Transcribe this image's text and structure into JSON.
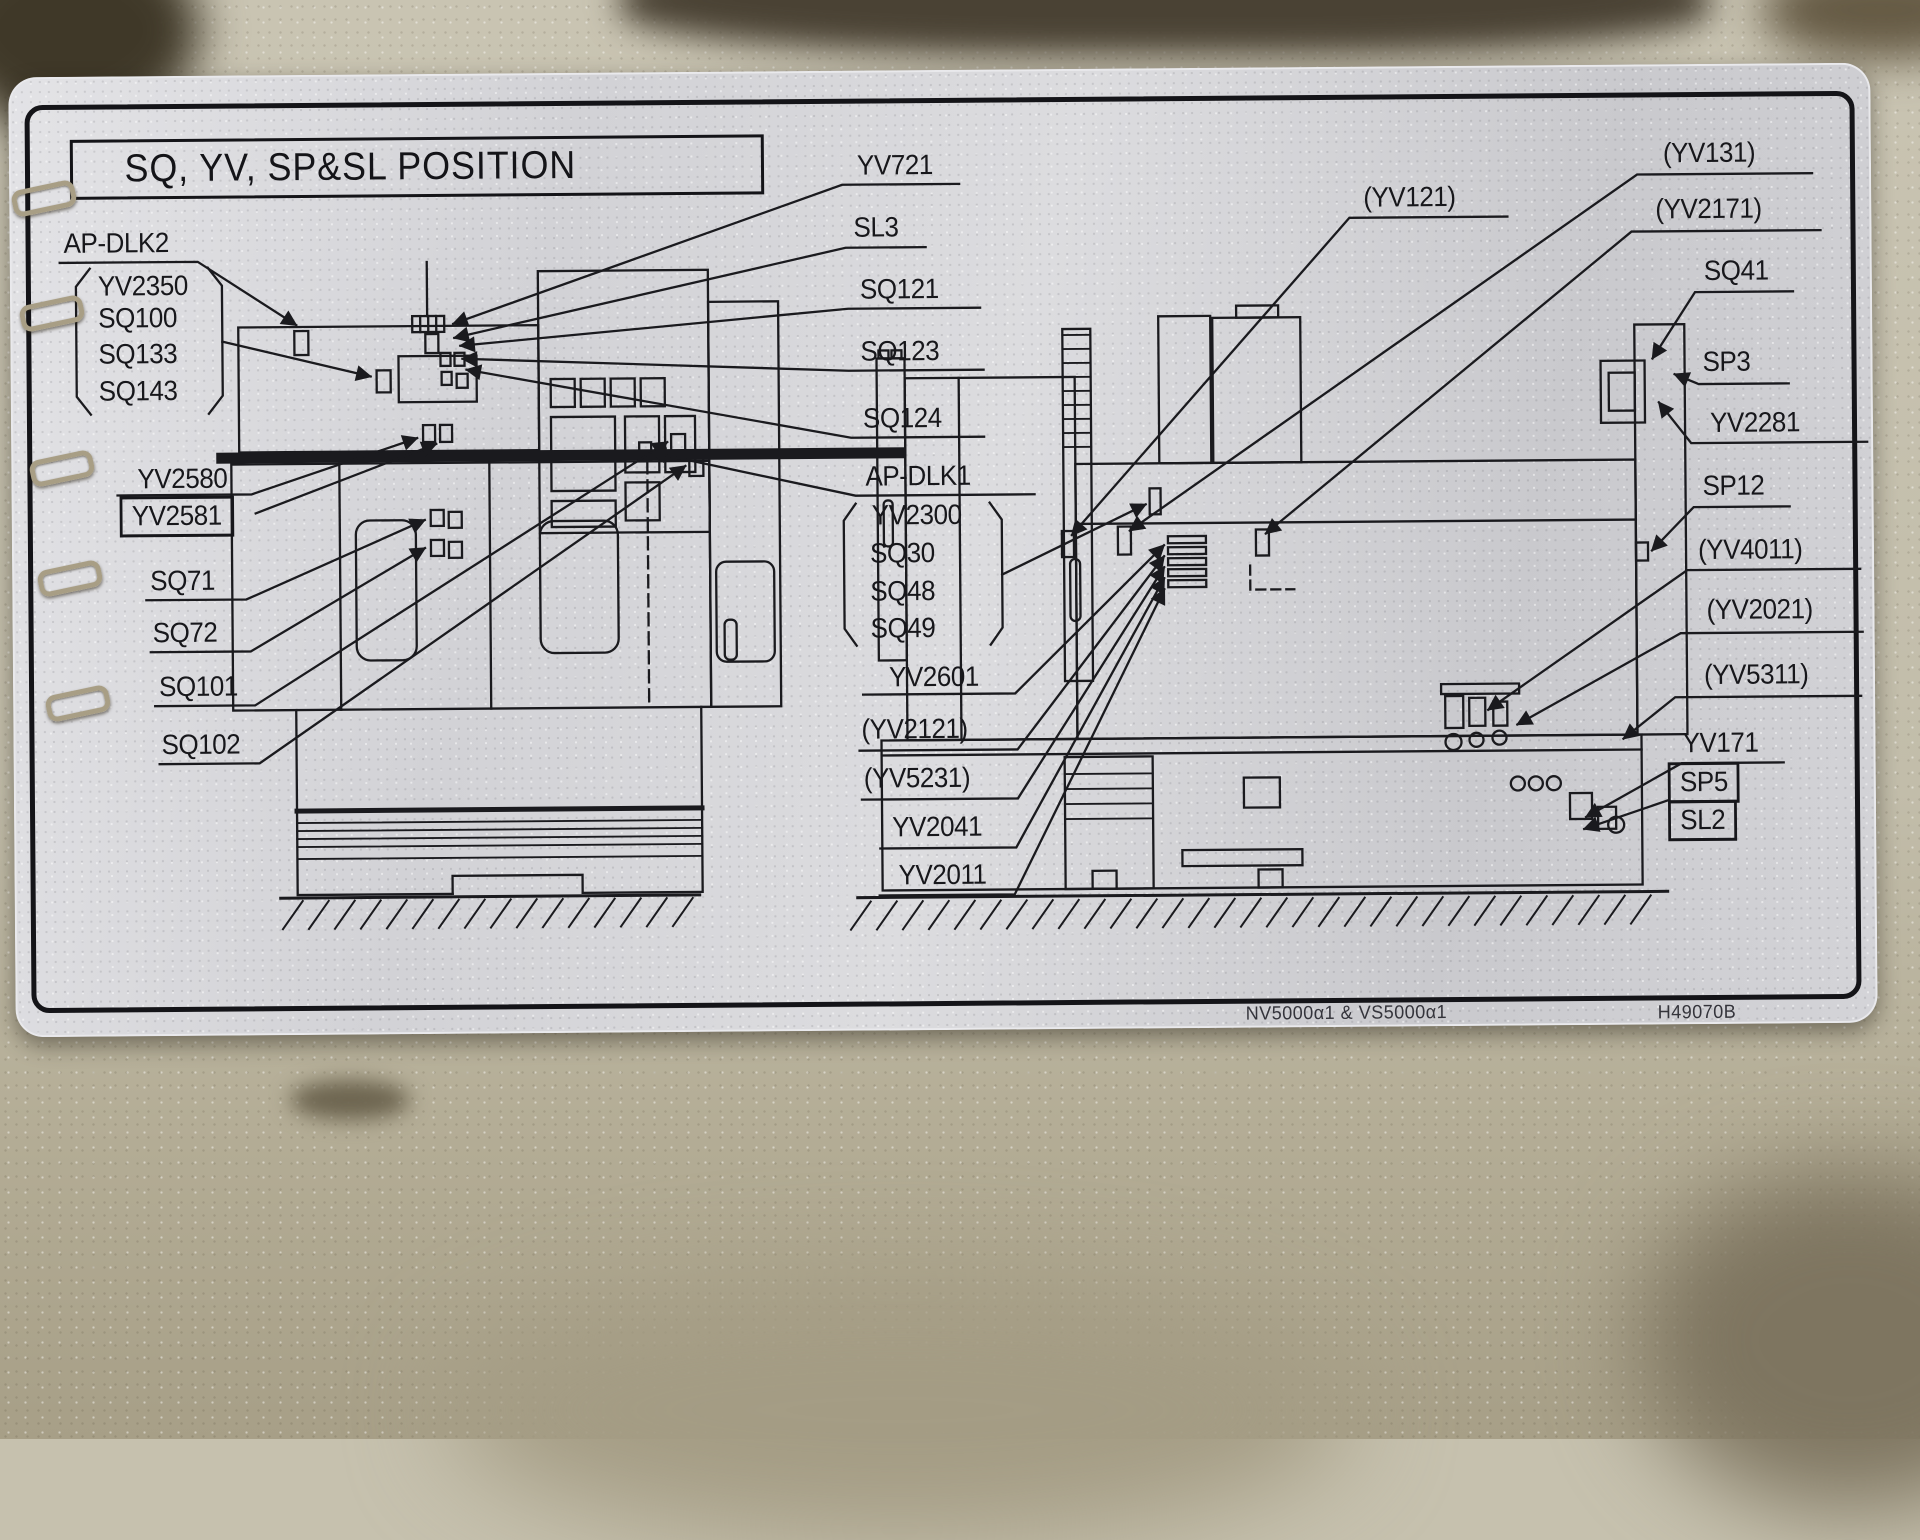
{
  "plate": {
    "title": "SQ, YV, SP&SL POSITION",
    "labels": {
      "ap_dlk2": "AP-DLK2",
      "yv2350": "YV2350",
      "sq100": "SQ100",
      "sq133": "SQ133",
      "sq143": "SQ143",
      "yv2580": "YV2580",
      "yv2581": "YV2581",
      "sq71": "SQ71",
      "sq72": "SQ72",
      "sq101": "SQ101",
      "sq102": "SQ102",
      "yv721": "YV721",
      "sl3": "SL3",
      "sq121": "SQ121",
      "sq123": "SQ123",
      "sq124": "SQ124",
      "ap_dlk1": "AP-DLK1",
      "yv2300": "YV2300",
      "sq30": "SQ30",
      "sq48": "SQ48",
      "sq49": "SQ49",
      "yv2601": "YV2601",
      "yv2121": "(YV2121)",
      "yv5231": "(YV5231)",
      "yv2041": "YV2041",
      "yv2011": "YV2011",
      "yv121": "(YV121)",
      "yv131": "(YV131)",
      "yv2171": "(YV2171)",
      "sq41": "SQ41",
      "sp3": "SP3",
      "yv2281": "YV2281",
      "sp12": "SP12",
      "yv4011": "(YV4011)",
      "yv2021": "(YV2021)",
      "yv5311": "(YV5311)",
      "yv171": "YV171",
      "sp5": "SP5",
      "sl2": "SL2"
    },
    "footer": {
      "model": "NV5000α1 & VS5000α1",
      "code": "H49070B"
    },
    "colors": {
      "plate": "#d6d6da",
      "line": "#1a1a1e",
      "wall": "#c3beab"
    }
  }
}
